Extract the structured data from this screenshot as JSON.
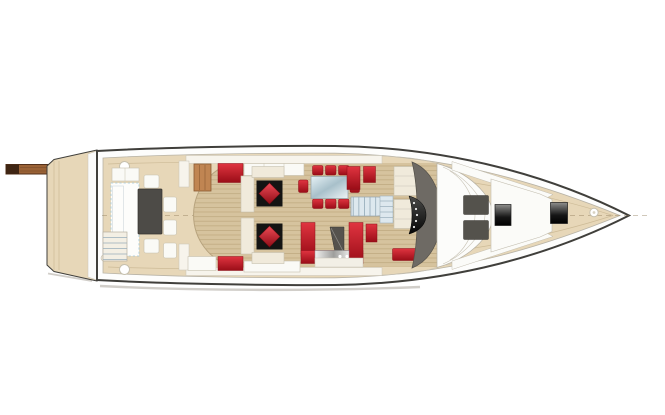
{
  "meta": {
    "content_type": "yacht-deck-plan-illustration",
    "orientation": "bow-right-stern-left",
    "visible_text": "none"
  },
  "colors": {
    "hull_outline": "#403f3b",
    "deck_beige": "#e7d7b8",
    "deck_edge": "#b8b3a6",
    "seam_tan": "#cdbb97",
    "wood_base": "#d6c39e",
    "wood_line": "#c1ab82",
    "wall_cream": "#f7f4ec",
    "wall_line": "#c8c3b5",
    "furniture_cream": "#f0eadb",
    "furniture_line": "#c6c0ae",
    "panel_white": "#fafaf6",
    "accent_red": "#c6101f",
    "accent_red_dark": "#8c0f18",
    "table_black": "#141413",
    "aft_table_gray": "#4d4b47",
    "console_gray": "#6e6a64",
    "sunpad_gray": "#54524c",
    "glass_blue": "#cfe0e8",
    "stair_blue": "#dde8ee",
    "stair_line": "#98aebb",
    "rug_blue": "#9fc6d8",
    "passerelle_brown": "#9a6236",
    "passerelle_tip": "#3f2513",
    "cabinet_brown": "#c08552",
    "cabinet_brown_dark": "#8a5a32",
    "centerline": "#8d7a5a",
    "shadow_gray": "#a39e93"
  },
  "parts": {
    "swim_platform": {
      "seams": 2,
      "passerelle": true
    },
    "aft_deck": {
      "dining_table": "dark-gray",
      "chairs": 5,
      "sofa_outline": "light-blue-dashed",
      "deck_hatches": 2,
      "transom_steps": 5
    },
    "salon": {
      "lounge_sets": 2,
      "lounge_cushion": "red-diamond-on-black-table",
      "dining_table": "glass",
      "dining_chairs": 8,
      "galley_counter": "red-u-shape",
      "companionway_stairs": true,
      "sideboards_red": 2,
      "cabinet_wood": 1
    },
    "helm": {
      "seats": 2,
      "console": "gray-crescent",
      "instrument_panel": "black",
      "bench_red": 1,
      "side_steps": true
    },
    "foredeck": {
      "sunpads_gray": 2,
      "windlass_boxes": 2,
      "bow_fitting": 1,
      "white_panels": 3
    }
  }
}
